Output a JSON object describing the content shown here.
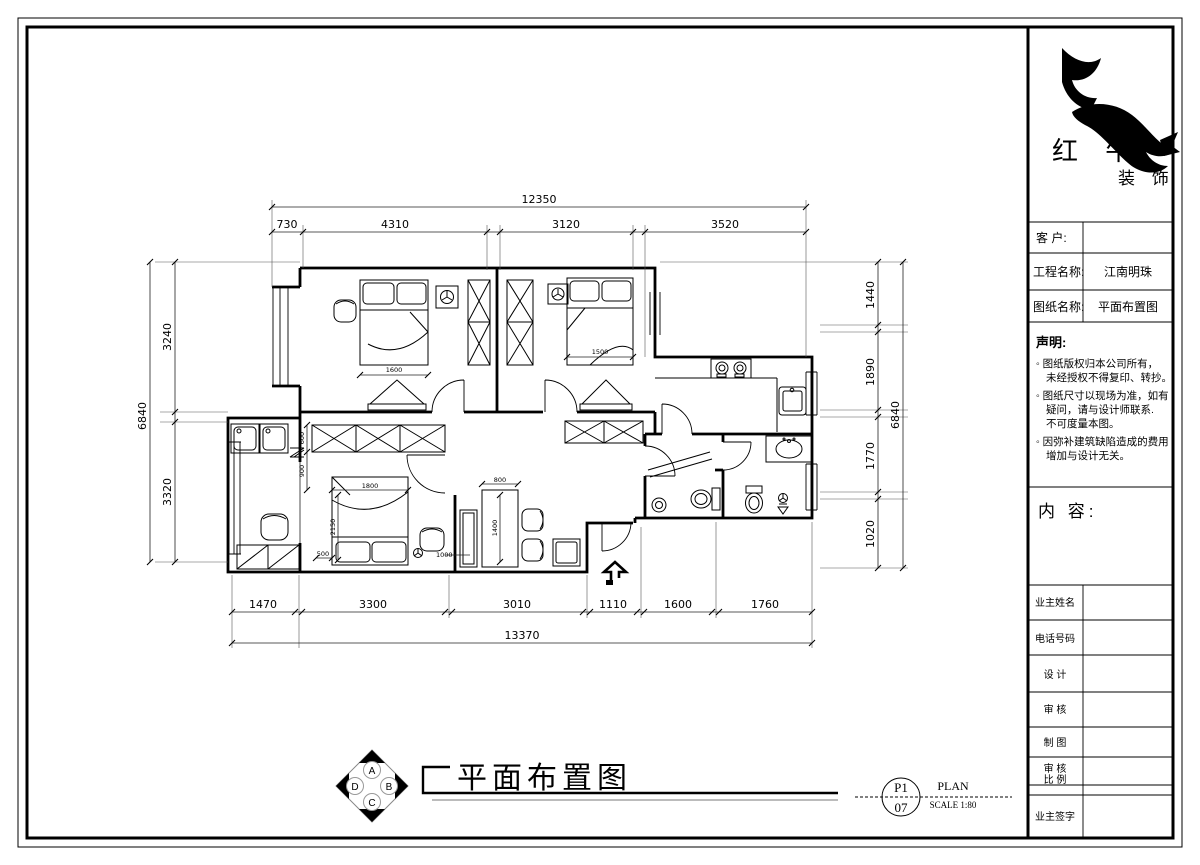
{
  "sheet": {
    "title": "平面布置图",
    "plan_label": "PLAN",
    "scale_label": "SCALE 1:80",
    "page_top": "P1",
    "page_bottom": "07"
  },
  "compass": {
    "n": "A",
    "e": "B",
    "s": "C",
    "w": "D"
  },
  "company": {
    "name_main": "红 牛",
    "name_sub": "装 饰"
  },
  "titleblock": {
    "customer_label": "客  户:",
    "project_label": "工程名称:",
    "project_value": "江南明珠",
    "drawing_label": "图纸名称:",
    "drawing_value": "平面布置图",
    "statement_title": "声明:",
    "statement_lines": [
      "◦ 图纸版权归本公司所有，",
      "未经授权不得复印、转抄。",
      "◦ 图纸尺寸以现场为准，如有",
      "疑问，请与设计师联系.",
      "不可度量本图。",
      "◦ 因弥补建筑缺陷造成的费用",
      "增加与设计无关。"
    ],
    "content_label": "内 容:",
    "owner_name_label": "业主姓名",
    "phone_label": "电话号码",
    "design_label": "设 计",
    "check_label": "审 核",
    "draft_label": "制 图",
    "check2_label": "审 核",
    "scale_row_label": "比 例",
    "owner_sign_label": "业主签字"
  },
  "dims": {
    "top": {
      "total": "12350",
      "segments": [
        "730",
        "4310",
        "3120",
        "3520"
      ]
    },
    "bottom": {
      "total": "13370",
      "segments": [
        "1470",
        "3300",
        "3010",
        "1110",
        "1600",
        "1760"
      ]
    },
    "left": {
      "total": "6840",
      "segments": [
        "3240",
        "3320"
      ]
    },
    "right": {
      "total": "6840",
      "segments": [
        "1440",
        "1890",
        "1770",
        "1020"
      ]
    },
    "interior": {
      "bed1": "1600",
      "bed2": "1500",
      "bed3_w": "1800",
      "bed3_h": "2150",
      "bed3_gap": "500",
      "bed3_side": "1000",
      "ward_depth": "600",
      "ward_gap": "900",
      "table_w": "800",
      "table_h": "1400"
    }
  }
}
